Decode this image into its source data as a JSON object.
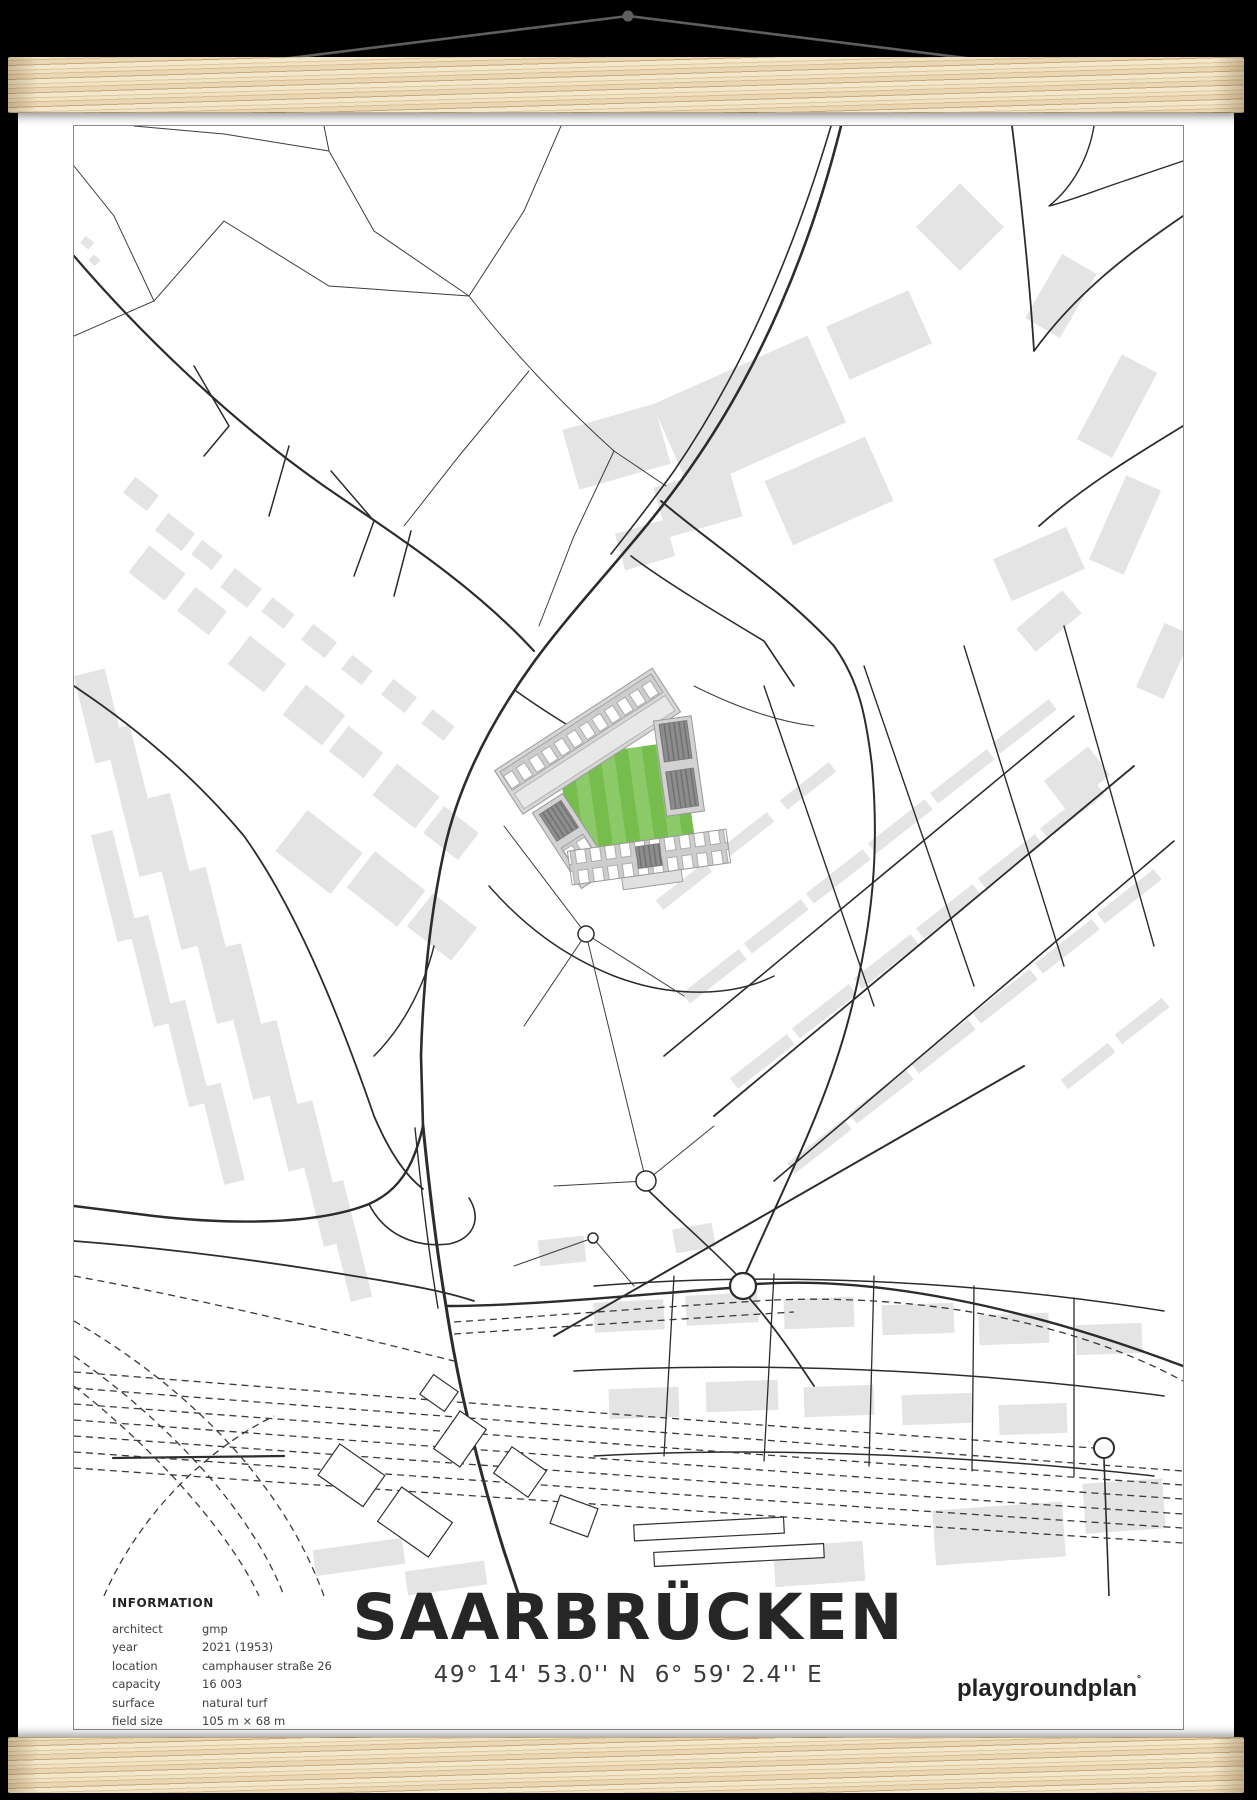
{
  "poster": {
    "title": "SAARBRÜCKEN",
    "coordinates": "49° 14' 53.0'' N  6° 59' 2.4'' E",
    "brand": "playgroundplan",
    "brand_mark": "°",
    "information": {
      "heading": "INFORMATION",
      "rows": [
        {
          "label": "architect",
          "value": "gmp"
        },
        {
          "label": "year",
          "value": "2021 (1953)"
        },
        {
          "label": "location",
          "value": "camphauser straße 26"
        },
        {
          "label": "capacity",
          "value": "16 003"
        },
        {
          "label": "surface",
          "value": "natural turf"
        },
        {
          "label": "field size",
          "value": "105 m × 68 m"
        }
      ]
    }
  },
  "colors": {
    "background": "#000000",
    "poster": "#ffffff",
    "frame_border": "#8a8a8a",
    "wood_light": "#f0e2c2",
    "wood_dark": "#c9a87c",
    "string": "#5f5f5f",
    "road": "#2c2c2c",
    "building": "#e4e4e4",
    "pitch_green_light": "#8cc968",
    "pitch_green_dark": "#76bd4e",
    "stand_gray": "#d2d2d2",
    "text": "#262626"
  }
}
